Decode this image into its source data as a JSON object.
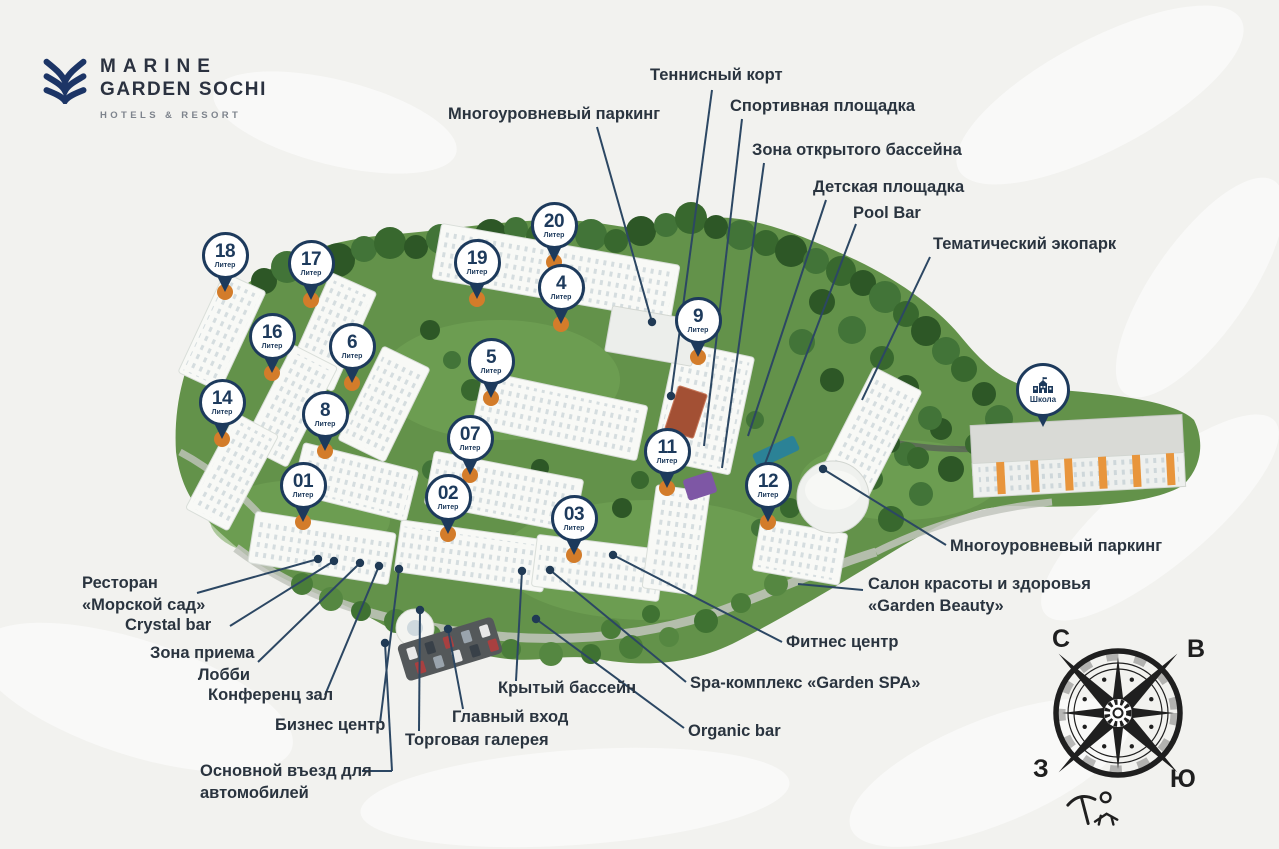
{
  "logo": {
    "line1": "MARINE",
    "line2": "GARDEN SOCHI",
    "tagline": "HOTELS & RESORT"
  },
  "colors": {
    "navy": "#1d3a5c",
    "orange": "#d37c2a",
    "ink": "#2a343f",
    "leader_line": "#2c4763",
    "grass": "#63924a",
    "forest": "#38682e"
  },
  "map": {
    "pins": [
      {
        "num": "18",
        "sub": "Литер",
        "x": 225,
        "y": 256
      },
      {
        "num": "17",
        "sub": "Литер",
        "x": 311,
        "y": 264
      },
      {
        "num": "20",
        "sub": "Литер",
        "x": 554,
        "y": 226
      },
      {
        "num": "19",
        "sub": "Литер",
        "x": 477,
        "y": 263
      },
      {
        "num": "4",
        "sub": "Литер",
        "x": 561,
        "y": 288
      },
      {
        "num": "16",
        "sub": "Литер",
        "x": 272,
        "y": 337
      },
      {
        "num": "6",
        "sub": "Литер",
        "x": 352,
        "y": 347
      },
      {
        "num": "5",
        "sub": "Литер",
        "x": 491,
        "y": 362
      },
      {
        "num": "9",
        "sub": "Литер",
        "x": 698,
        "y": 321
      },
      {
        "num": "14",
        "sub": "Литер",
        "x": 222,
        "y": 403
      },
      {
        "num": "8",
        "sub": "Литер",
        "x": 325,
        "y": 415
      },
      {
        "num": "07",
        "sub": "Литер",
        "x": 470,
        "y": 439
      },
      {
        "num": "11",
        "sub": "Литер",
        "x": 667,
        "y": 452
      },
      {
        "num": "12",
        "sub": "Литер",
        "x": 768,
        "y": 486
      },
      {
        "num": "01",
        "sub": "Литер",
        "x": 303,
        "y": 486
      },
      {
        "num": "02",
        "sub": "Литер",
        "x": 448,
        "y": 498
      },
      {
        "num": "03",
        "sub": "Литер",
        "x": 574,
        "y": 519
      }
    ],
    "school_pin": {
      "label": "Школа",
      "x": 1043,
      "y": 391
    }
  },
  "callouts": [
    {
      "id": "tennis-court",
      "lines": [
        "Теннисный корт"
      ],
      "x": 650,
      "y": 64,
      "segs": [
        [
          712,
          90,
          671,
          396
        ]
      ],
      "dot": true
    },
    {
      "id": "multilevel-parking-top",
      "lines": [
        "Многоуровневый паркинг"
      ],
      "x": 448,
      "y": 103,
      "segs": [
        [
          597,
          127,
          652,
          322
        ]
      ],
      "dot": true
    },
    {
      "id": "sports-ground",
      "lines": [
        "Спортивная площадка"
      ],
      "x": 730,
      "y": 95,
      "segs": [
        [
          742,
          119,
          704,
          446
        ]
      ],
      "dot": false
    },
    {
      "id": "outdoor-pool-zone",
      "lines": [
        "Зона открытого бассейна"
      ],
      "x": 752,
      "y": 139,
      "segs": [
        [
          764,
          163,
          722,
          468
        ]
      ],
      "dot": false
    },
    {
      "id": "playground",
      "lines": [
        "Детская площадка"
      ],
      "x": 813,
      "y": 176,
      "segs": [
        [
          826,
          200,
          748,
          436
        ]
      ],
      "dot": false
    },
    {
      "id": "pool-bar",
      "lines": [
        "Pool Bar"
      ],
      "x": 853,
      "y": 202,
      "segs": [
        [
          856,
          224,
          752,
          498
        ]
      ],
      "dot": false
    },
    {
      "id": "eco-park",
      "lines": [
        "Тематический экопарк"
      ],
      "x": 933,
      "y": 233,
      "segs": [
        [
          930,
          257,
          862,
          400
        ]
      ],
      "dot": false
    },
    {
      "id": "multilevel-parking-right",
      "lines": [
        "Многоуровневый паркинг"
      ],
      "x": 950,
      "y": 535,
      "segs": [
        [
          946,
          545,
          823,
          469
        ]
      ],
      "dot": true
    },
    {
      "id": "garden-beauty-salon",
      "lines": [
        "Салон красоты и здоровья",
        "«Garden Beauty»"
      ],
      "x": 868,
      "y": 573,
      "segs": [
        [
          863,
          590,
          798,
          584
        ]
      ],
      "dot": false
    },
    {
      "id": "fitness-center",
      "lines": [
        "Фитнес центр"
      ],
      "x": 786,
      "y": 631,
      "segs": [
        [
          782,
          642,
          613,
          555
        ]
      ],
      "dot": true
    },
    {
      "id": "garden-spa",
      "lines": [
        "Spa-комплекс «Garden SPA»"
      ],
      "x": 690,
      "y": 672,
      "segs": [
        [
          686,
          682,
          550,
          570
        ]
      ],
      "dot": true
    },
    {
      "id": "organic-bar",
      "lines": [
        "Organic bar"
      ],
      "x": 688,
      "y": 720,
      "segs": [
        [
          684,
          728,
          536,
          619
        ]
      ],
      "dot": true
    },
    {
      "id": "sea-garden-restaurant",
      "lines": [
        "Ресторан",
        "«Морской сад»"
      ],
      "x": 82,
      "y": 572,
      "segs": [
        [
          197,
          593,
          318,
          559
        ]
      ],
      "dot": true
    },
    {
      "id": "crystal-bar",
      "lines": [
        "Crystal bar"
      ],
      "x": 125,
      "y": 614,
      "segs": [
        [
          230,
          626,
          334,
          561
        ]
      ],
      "dot": true
    },
    {
      "id": "reception-lobby",
      "lines": [
        "Зона приема",
        "Лобби"
      ],
      "x": 150,
      "y": 642,
      "align": "right",
      "w": 100,
      "segs": [
        [
          258,
          662,
          360,
          563
        ]
      ],
      "dot": true
    },
    {
      "id": "conference-hall",
      "lines": [
        "Конференц зал"
      ],
      "x": 208,
      "y": 684,
      "segs": [
        [
          325,
          695,
          379,
          566
        ]
      ],
      "dot": true
    },
    {
      "id": "business-center",
      "lines": [
        "Бизнес центр"
      ],
      "x": 275,
      "y": 714,
      "segs": [
        [
          380,
          723,
          399,
          569
        ]
      ],
      "dot": true
    },
    {
      "id": "shopping-gallery",
      "lines": [
        "Торговая галерея"
      ],
      "x": 405,
      "y": 729,
      "segs": [
        [
          419,
          731,
          420,
          610
        ]
      ],
      "dot": true
    },
    {
      "id": "main-entrance",
      "lines": [
        "Главный вход"
      ],
      "x": 452,
      "y": 706,
      "segs": [
        [
          463,
          709,
          448,
          629
        ]
      ],
      "dot": true
    },
    {
      "id": "indoor-pool",
      "lines": [
        "Крытый бассейн"
      ],
      "x": 498,
      "y": 677,
      "segs": [
        [
          516,
          681,
          522,
          571
        ]
      ],
      "dot": true
    },
    {
      "id": "main-car-entrance",
      "lines": [
        "Основной въезд для",
        "автомобилей"
      ],
      "x": 200,
      "y": 760,
      "segs": [
        [
          362,
          771,
          392,
          771
        ],
        [
          392,
          771,
          385,
          643
        ]
      ],
      "dot": true
    }
  ],
  "compass": {
    "north": "С",
    "east": "В",
    "west": "З",
    "south": "Ю"
  }
}
